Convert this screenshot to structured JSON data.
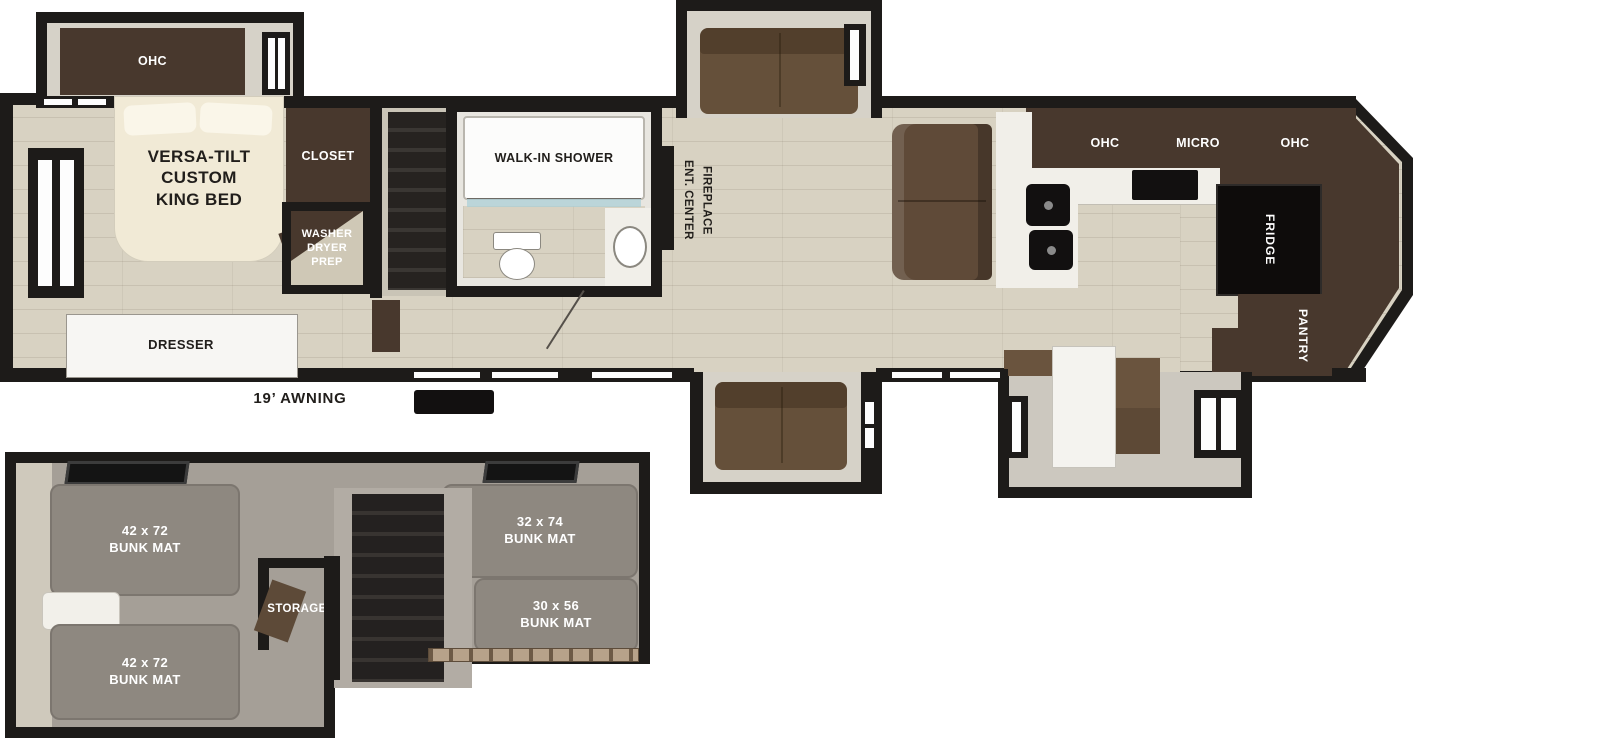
{
  "main_floor": {
    "bedroom": {
      "ohc": "OHC",
      "bed": "VERSA-TILT\nCUSTOM\nKING BED",
      "closet": "CLOSET",
      "washer_dryer": "WASHER\nDRYER\nPREP",
      "dresser": "DRESSER"
    },
    "bathroom": {
      "shower": "WALK-IN SHOWER"
    },
    "living": {
      "ent_center": "ENT. CENTER\nFIREPLACE"
    },
    "kitchen": {
      "ohc_left": "OHC",
      "micro": "MICRO",
      "ohc_right": "OHC",
      "fridge": "FRIDGE",
      "pantry": "PANTRY"
    },
    "awning": "19’ AWNING"
  },
  "bunk_room": {
    "bunk_top_left": "42 x 72\nBUNK MAT",
    "bunk_bottom_left": "42 x 72\nBUNK MAT",
    "bunk_top_right": "32 x 74\nBUNK MAT",
    "bunk_bottom_right": "30 x 56\nBUNK MAT",
    "storage": "STORAGE"
  },
  "colors": {
    "wall": "#1d1b19",
    "wood_floor": "#d8d2c2",
    "cabinet_dark": "#48382d",
    "sofa_brown": "#65503a",
    "bed_cream": "#f1ead6",
    "mat_gray": "#8e8880",
    "carpet_gray": "#a59f97",
    "carpet_light": "#cfc9bc",
    "slide_interior": "#d6d2c8",
    "counter_white": "#f1efe9",
    "appliance_black": "#121010",
    "table_white": "#f4f3ef",
    "rail_tan": "#b7a28a"
  }
}
